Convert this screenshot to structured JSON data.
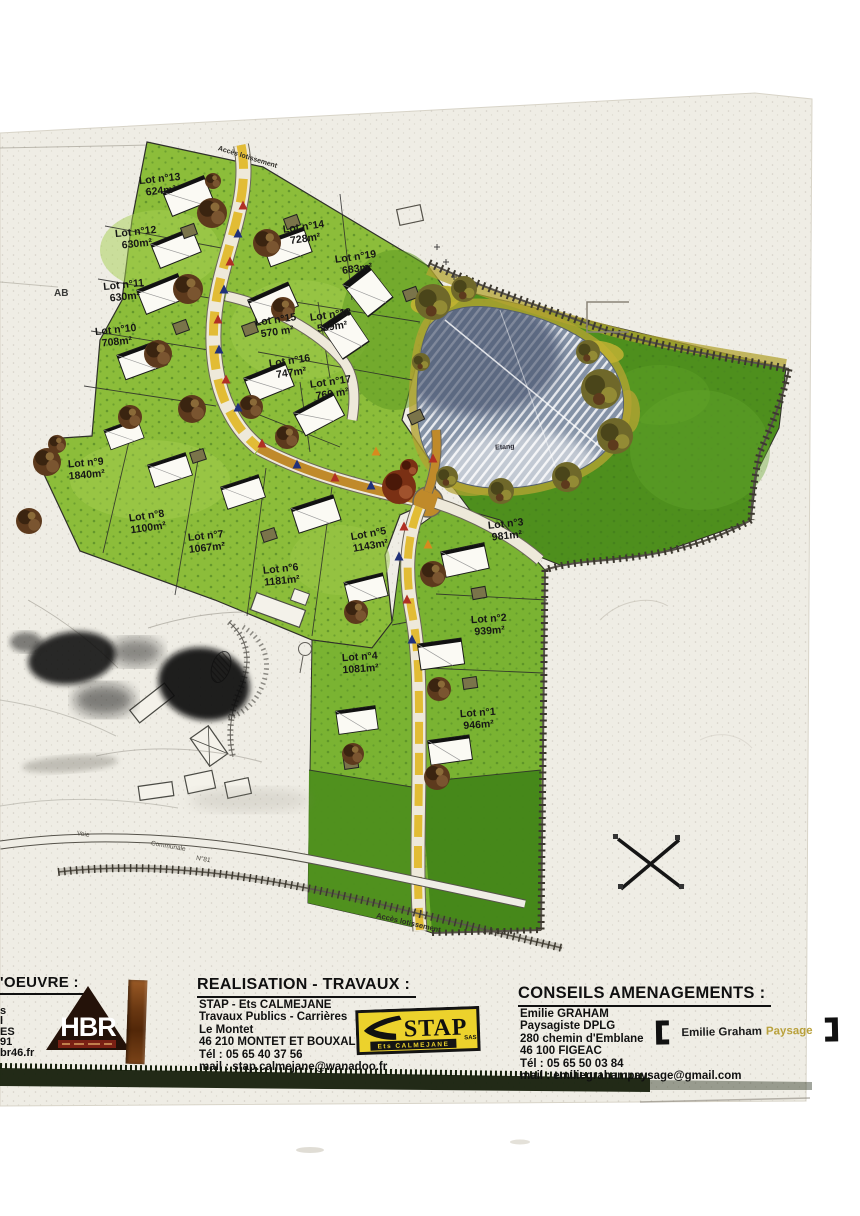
{
  "map": {
    "section_label": "AB",
    "pond_label": "Etang",
    "access_road_top": "Accès lotissement",
    "access_road_bottom": "Accès lotissement",
    "voie_label": "Voie",
    "communale_label": "Communale",
    "road_number_label": "N°81",
    "lots": [
      {
        "name": "Lot n°1",
        "area": "946m²"
      },
      {
        "name": "Lot n°2",
        "area": "939m²"
      },
      {
        "name": "Lot n°3",
        "area": "981m²"
      },
      {
        "name": "Lot n°4",
        "area": "1081m²"
      },
      {
        "name": "Lot n°5",
        "area": "1143m²"
      },
      {
        "name": "Lot n°6",
        "area": "1181m²"
      },
      {
        "name": "Lot n°7",
        "area": "1067m²"
      },
      {
        "name": "Lot n°8",
        "area": "1100m²"
      },
      {
        "name": "Lot n°9",
        "area": "1840m²"
      },
      {
        "name": "Lot n°10",
        "area": "708m²"
      },
      {
        "name": "Lot n°11",
        "area": "630m²"
      },
      {
        "name": "Lot n°12",
        "area": "630m²"
      },
      {
        "name": "Lot n°13",
        "area": "624m²"
      },
      {
        "name": "Lot n°14",
        "area": "728m²"
      },
      {
        "name": "Lot n°15",
        "area": "570 m²"
      },
      {
        "name": "Lot n°16",
        "area": "747m²"
      },
      {
        "name": "Lot n°17",
        "area": "760 m²"
      },
      {
        "name": "Lot n°18",
        "area": "589m²"
      },
      {
        "name": "Lot n°19",
        "area": "683m²"
      }
    ]
  },
  "footer": {
    "left": {
      "title_fragment": "'OEUVRE :",
      "cut_lines": [
        "s",
        "l",
        "ES",
        "91",
        "br46.fr"
      ],
      "hbr_logo_text": "HBR"
    },
    "center": {
      "title": "REALISATION - TRAVAUX :",
      "lines": [
        "STAP - Ets CALMEJANE",
        "Travaux Publics - Carrières",
        "Le Montet",
        "46 210 MONTET ET BOUXAL",
        "Tél : 05 65 40 37 56",
        "mail : stap.calmejane@wanadoo.fr"
      ],
      "stap_logo_main": "STAP",
      "stap_logo_sas": "SAS",
      "stap_logo_sub": "Ets CALMEJANE"
    },
    "right": {
      "title": "CONSEILS AMENAGEMENTS :",
      "lines": [
        "Emilie GRAHAM",
        "Paysagiste DPLG",
        "280 chemin d'Emblane",
        "46 100 FIGEAC",
        "Tél : 05 65 50 03 84",
        "mail : emiliegrahampaysage@gmail.com"
      ],
      "graham_logo_name": "Emilie Graham",
      "graham_logo_word": "Paysage"
    }
  },
  "colors": {
    "paper": "#efede5",
    "lot_green": "#8cbd3a",
    "meadow_green": "#4e8f1d",
    "road_yellow": "#e2bc35",
    "road_tan": "#c08a2a",
    "pond_gray_blue": "#8492a6",
    "stap_yellow": "#ecd22c",
    "hbr_dark": "#241209"
  }
}
